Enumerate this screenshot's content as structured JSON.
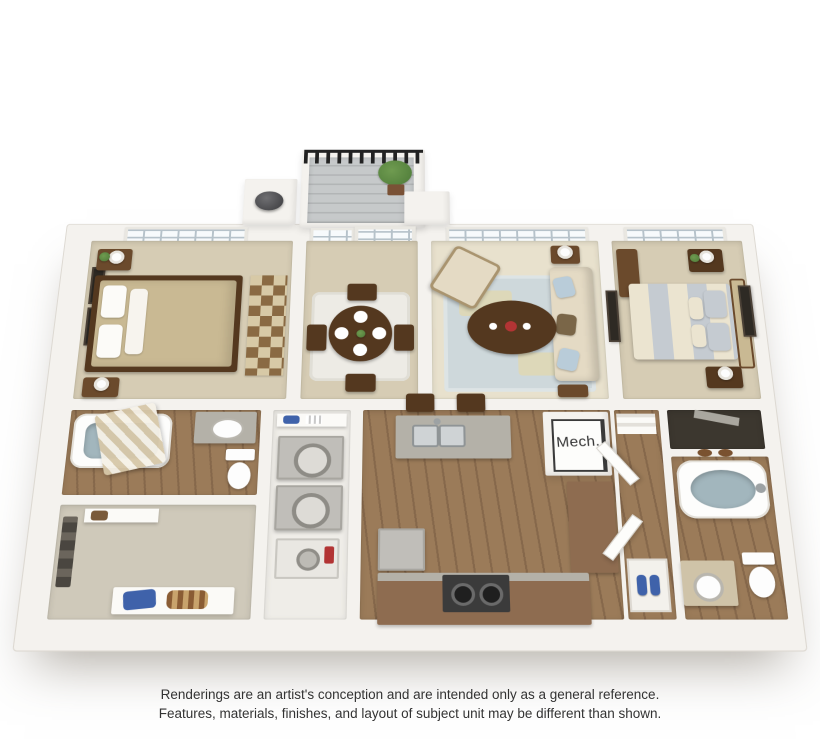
{
  "labels": {
    "mech_closet": "Mech."
  },
  "disclaimer": {
    "line1": "Renderings are an artist's conception and are intended only as a general reference.",
    "line2": "Features, materials, finishes, and layout of subject unit may be different than shown."
  },
  "colors": {
    "page_bg": "#ffffff",
    "wall": "#f4f2ee",
    "wall_edge": "#ddd9d2",
    "carpet": "#d6ccb4",
    "carpet_light": "#e8e1cd",
    "carpet_closet": "#cfc9ba",
    "wood": "#9b7b59",
    "wood_dark": "#86684b",
    "rug_living": "#ced8db",
    "rug_accent": "#e7d8a2",
    "rug_dining": "#edebe5",
    "wood_furniture": "#54381f",
    "wood_furniture_light": "#6b4a2c",
    "duvet_tan": "#c9b993",
    "stripe_gray": "#c5cbd1",
    "stripe_cream": "#ebe4d0",
    "sofa": "#e4dac4",
    "pillow_blue": "#b9ccd9",
    "deck": "#bfc2c3",
    "railing": "#222222",
    "plant": "#4d7a38",
    "water": "#a2b6bd",
    "counter": "#b4b1a8",
    "cabinet_brown": "#8e6c50",
    "appliance": "#c0beb9",
    "stove": "#3b3b3b",
    "accent_red": "#b23434",
    "shoe_blue": "#3f62aa",
    "closet_dark": "#3c372f",
    "window_frame": "#e9e7e1",
    "window_pane": "#f7fafc",
    "pane_line": "#b6c2ca",
    "text": "#333333"
  }
}
